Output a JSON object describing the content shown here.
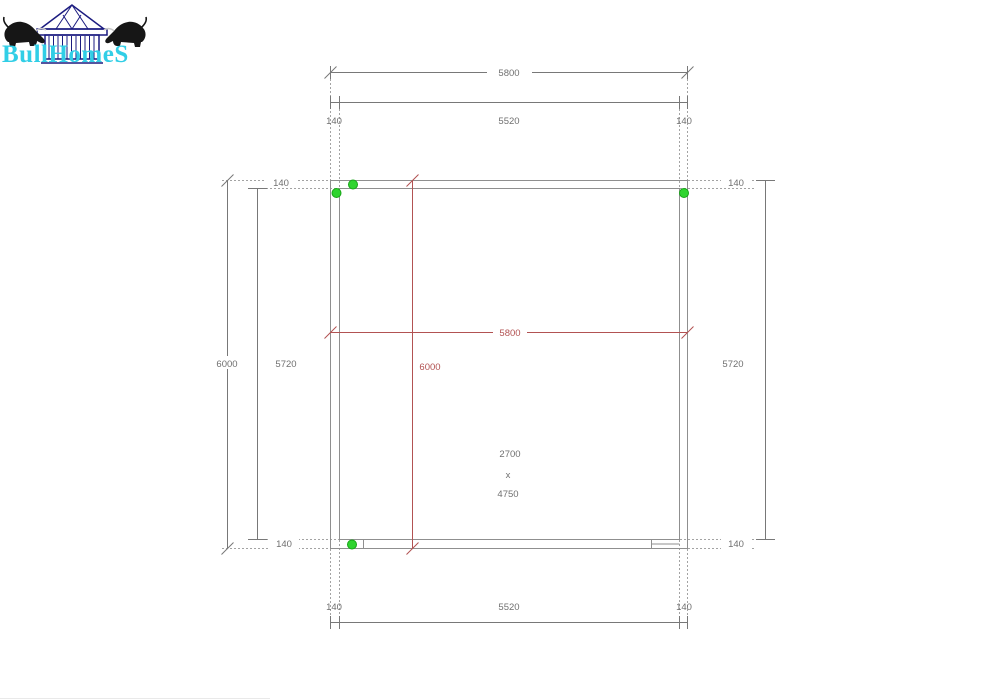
{
  "logo": {
    "brand": "BullHomeS"
  },
  "plan": {
    "top": {
      "overall": "5800",
      "inner": "5520",
      "left_wall": "140",
      "right_wall": "140"
    },
    "bottom": {
      "inner": "5520",
      "left_wall": "140",
      "right_wall": "140"
    },
    "left": {
      "overall": "6000",
      "inner": "5720",
      "top_wall": "140",
      "bottom_wall": "140"
    },
    "right": {
      "inner": "5720",
      "top_wall": "140",
      "bottom_wall": "140"
    },
    "interior": {
      "width": "5800",
      "height": "6000"
    },
    "room": {
      "width": "2700",
      "separator": "x",
      "length": "4750"
    }
  },
  "colors": {
    "brand_text": "#31cee6",
    "house_outline": "#1b1b80",
    "bull_silhouette": "#161616",
    "wall_line": "#8f8f8f",
    "dimension_line": "#787878",
    "red_dimension": "#b25252",
    "corner_marker": "#2fd42f",
    "label_text": "#707070"
  }
}
